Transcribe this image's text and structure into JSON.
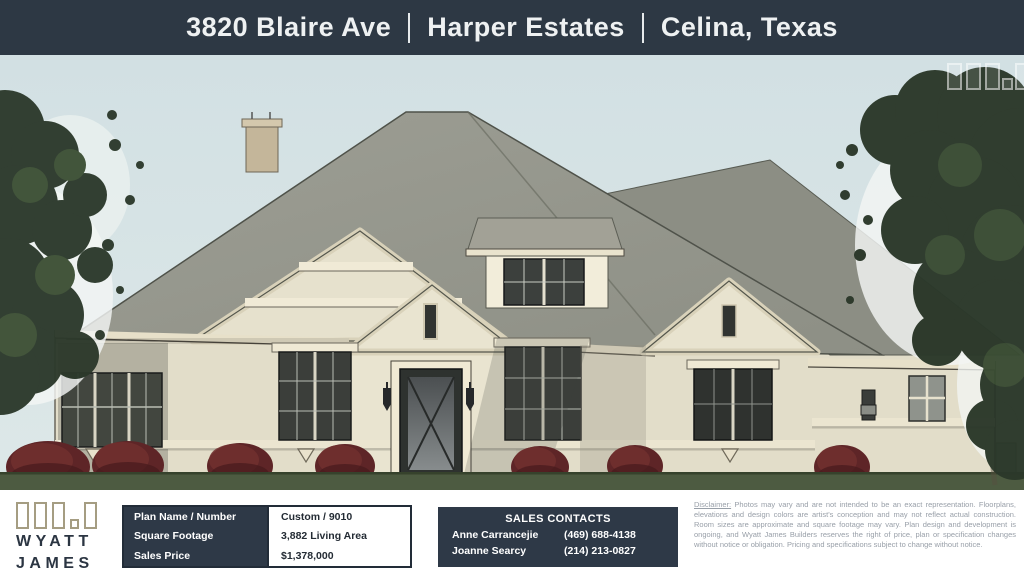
{
  "header": {
    "address": "3820 Blaire Ave",
    "community": "Harper Estates",
    "city": "Celina, Texas"
  },
  "branding": {
    "name_line1": "WYATT",
    "name_line2": "JAMES"
  },
  "plan_table": {
    "rows": [
      {
        "label": "Plan Name / Number",
        "value": "Custom / 9010"
      },
      {
        "label": "Square Footage",
        "value": "3,882 Living Area"
      },
      {
        "label": "Sales Price",
        "value": "$1,378,000"
      }
    ]
  },
  "sales_contacts": {
    "title": "SALES CONTACTS",
    "contacts": [
      {
        "name": "Anne Carrancejie",
        "phone": "(469) 688-4138"
      },
      {
        "name": "Joanne Searcy",
        "phone": "(214) 213-0827"
      }
    ]
  },
  "disclaimer": {
    "label": "Disclaimer:",
    "text": " Photos may vary and are not intended to be an exact representation. Floorplans, elevations and design colors are artist's conception and may not reflect actual construction. Room sizes are approximate and square footage may vary. Plan design and development is ongoing, and Wyatt James Builders reserves the right of price, plan or specification changes without notice or obligation. Pricing and specifications subject to change without notice."
  },
  "colors": {
    "header_bg": "#2d3844",
    "panel_navy": "#2e3947",
    "sky": "#d5e2e4",
    "roof": "#9a9b91",
    "wall": "#e2ddc9",
    "trim": "#efe9d4",
    "shrub": "#5e2527",
    "grass": "#4d5b41",
    "logo_block_outline": "#a59d82",
    "logo_text": "#2b3542"
  }
}
